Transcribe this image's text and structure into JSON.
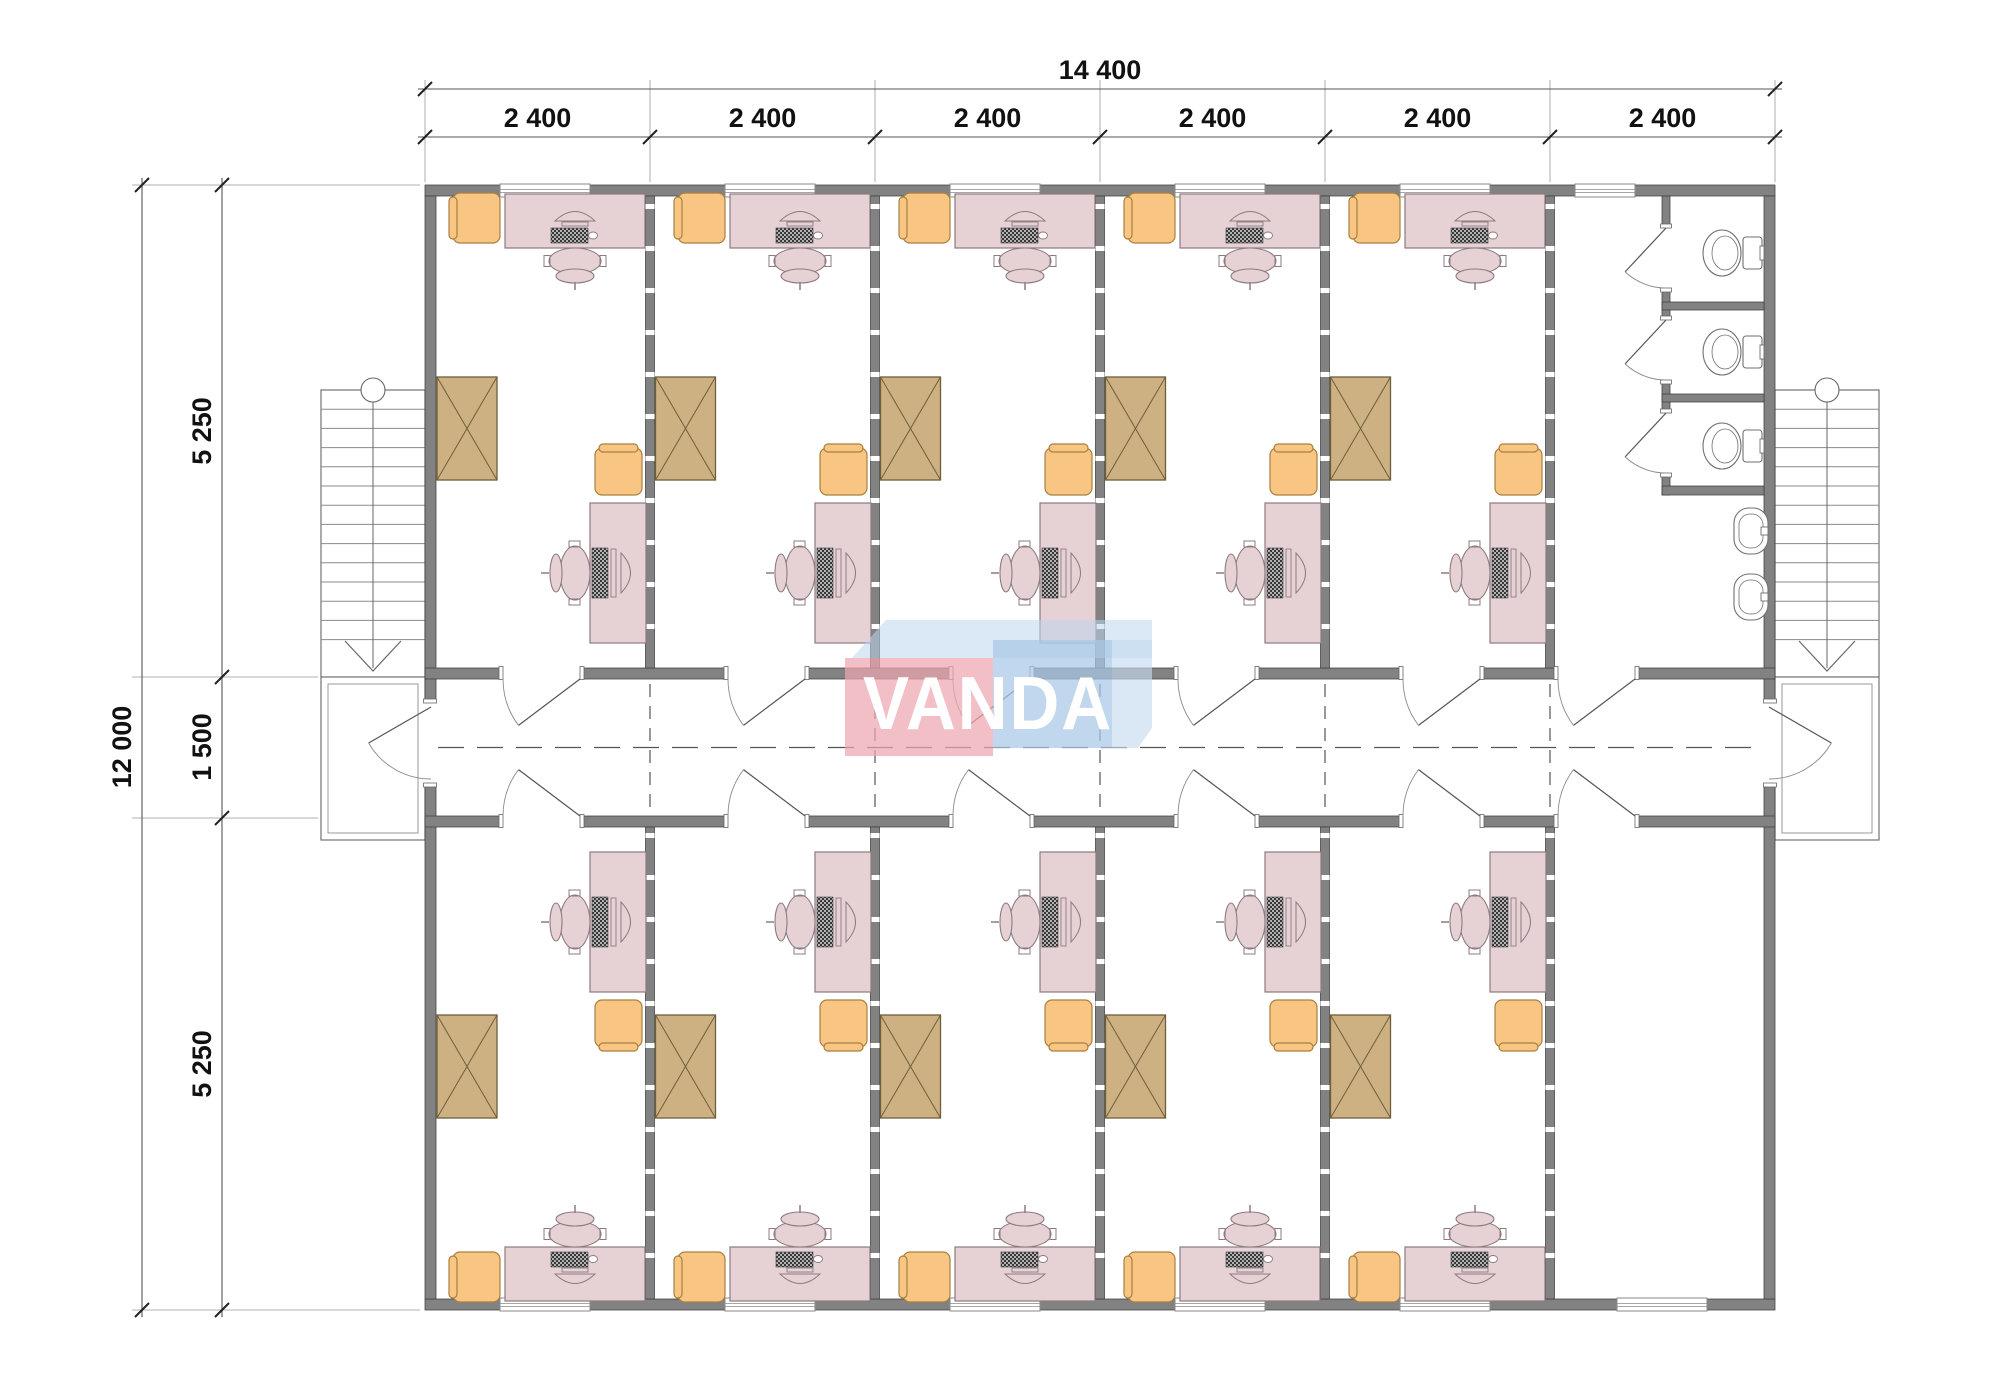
{
  "drawing": {
    "type": "architectural-floor-plan",
    "units": "mm"
  },
  "dimensions": {
    "top_total": "14 400",
    "top_bays": [
      "2 400",
      "2 400",
      "2 400",
      "2 400",
      "2 400",
      "2 400"
    ],
    "left_total": "12 000",
    "left_segments": [
      "5 250",
      "1 500",
      "5 250"
    ]
  },
  "watermark": {
    "text": "VANDA",
    "pink_block_color": "#eba6af",
    "blue_block_color": "#a9c8e6",
    "blue_light_color": "#c6dbf0",
    "band_color": "#bdd5ec",
    "text_color": "#ffffff"
  },
  "colors": {
    "wall": "#828282",
    "wall_edge": "#3f3f3f",
    "desk": "#e6d1d5",
    "desk_edge": "#8d7b81",
    "chair_orange": "#f9c582",
    "chair_orange_edge": "#a8803f",
    "cabinet": "#cdb183",
    "cabinet_edge": "#6e5f3a",
    "fixture": "#ffffff",
    "fixture_edge": "#6f6f6f",
    "line": "#555555",
    "thin_line": "#888888",
    "dim_text": "#111111"
  },
  "plan": {
    "offices_top": 5,
    "offices_bottom": 5,
    "toilet_stalls": 3,
    "sinks": 2,
    "stairs": 2,
    "building": {
      "x0": 425,
      "y0": 185,
      "x1": 1775,
      "y1": 1310
    },
    "bays": [
      425,
      650,
      875,
      1100,
      1325,
      1550,
      1775
    ],
    "corridor": {
      "top_wall_y": 668,
      "bottom_wall_y": 816,
      "wall_thickness": 11,
      "centerline_y": 747.5
    }
  }
}
